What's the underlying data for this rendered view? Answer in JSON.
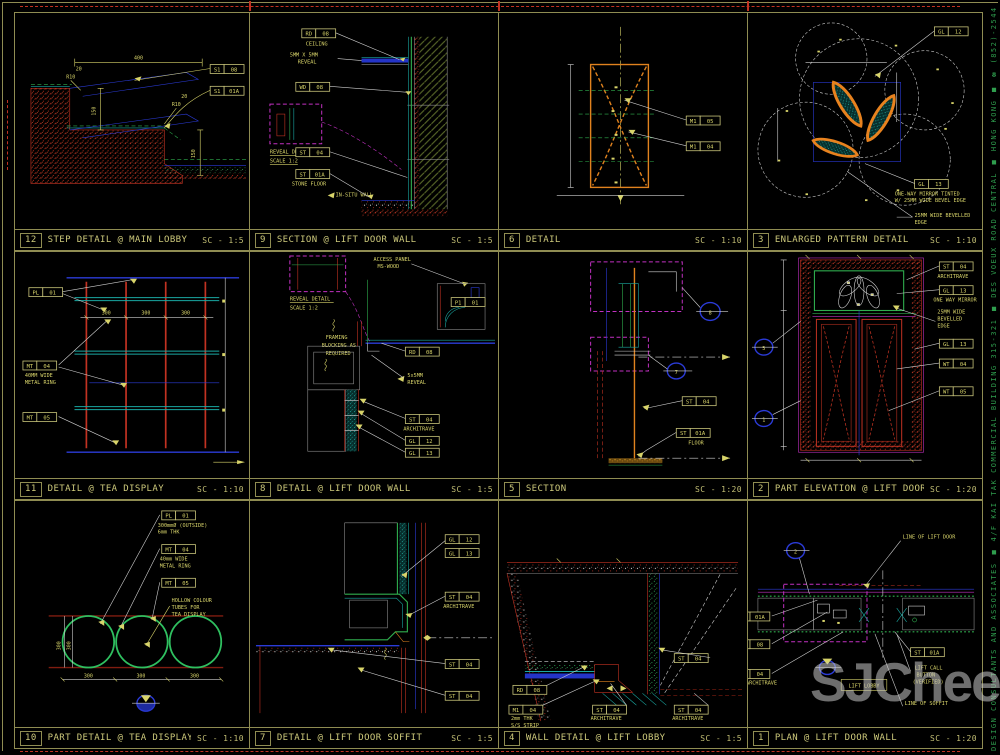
{
  "page": {
    "watermark": "SJCheese",
    "margin_text": "DESIGN CONSULTANTS AND ASSOCIATES ■ 4/F KAI TAK COMMERCIAL BUILDING 315-321 ■ DES VOEUX ROAD CENTRAL ■ HONG KONG ■ ☎ (852)-2544-302"
  },
  "panels": [
    {
      "num": "12",
      "title": "STEP DETAIL @ MAIN LOBBY",
      "scale": "SC - 1:5",
      "tags": [
        [
          "S1",
          "08"
        ],
        [
          "S1",
          "01A"
        ]
      ],
      "dims": [
        "400",
        "150",
        "150",
        "R10",
        "R10",
        "20",
        "20"
      ]
    },
    {
      "num": "9",
      "title": "SECTION @ LIFT DOOR WALL",
      "scale": "SC - 1:5",
      "tags": [
        [
          "RD",
          "08"
        ],
        [
          "WD",
          "08"
        ],
        [
          "ST",
          "04"
        ],
        [
          "ST",
          "01A"
        ]
      ],
      "labels": [
        "CEILING",
        "REVEAL DETAIL",
        "SCALE 1:2",
        "STONE FLOOR",
        "IN-SITU WALL",
        "5MM X 5MM",
        "REVEAL"
      ]
    },
    {
      "num": "6",
      "title": "DETAIL",
      "scale": "SC - 1:10",
      "tags": [
        [
          "M1",
          "05"
        ],
        [
          "M1",
          "04"
        ]
      ]
    },
    {
      "num": "3",
      "title": "ENLARGED PATTERN DETAIL",
      "scale": "SC - 1:10",
      "tags": [
        [
          "GL",
          "12"
        ],
        [
          "GL",
          "13"
        ]
      ],
      "labels": [
        "ONE-WAY MIRROR TINTED",
        "W/ 25MM WIDE BEVEL EDGE",
        "25MM WIDE BEVELLED",
        "EDGE"
      ]
    },
    {
      "num": "11",
      "title": "DETAIL @ TEA DISPLAY",
      "scale": "SC - 1:10",
      "tags": [
        [
          "PL",
          "01"
        ],
        [
          "MT",
          "04"
        ],
        [
          "MT",
          "05"
        ]
      ],
      "labels": [
        "40MM WIDE",
        "METAL RING"
      ],
      "dims": [
        "300",
        "300",
        "300"
      ]
    },
    {
      "num": "8",
      "title": "DETAIL @ LIFT DOOR WALL",
      "scale": "SC - 1:5",
      "tags": [
        [
          "P1",
          "01"
        ],
        [
          "RD",
          "08"
        ],
        [
          "ST",
          "04"
        ],
        [
          "GL",
          "12"
        ],
        [
          "GL",
          "13"
        ]
      ],
      "labels": [
        "ACCESS PANEL",
        "MS-WOOD",
        "REVEAL DETAIL",
        "SCALE 1:2",
        "FRAMING",
        "BLOCKING AS",
        "REQUIRED",
        "5x5MM",
        "REVEAL",
        "ARCHITRAVE"
      ]
    },
    {
      "num": "5",
      "title": "SECTION",
      "scale": "SC - 1:20",
      "tags": [
        [
          "ST",
          "04"
        ],
        [
          "ST",
          "01A"
        ]
      ],
      "labels": [
        "FLOOR"
      ],
      "callouts": [
        "8",
        "7"
      ]
    },
    {
      "num": "2",
      "title": "PART ELEVATION @ LIFT DOOR",
      "scale": "SC - 1:20",
      "tags": [
        [
          "ST",
          "04"
        ],
        [
          "GL",
          "13"
        ],
        [
          "GL",
          "13"
        ],
        [
          "WT",
          "04"
        ],
        [
          "WT",
          "05"
        ]
      ],
      "labels": [
        "ARCHITRAVE",
        "ONE WAY MIRROR",
        "25MM WIDE",
        "BEVELLED",
        "EDGE"
      ],
      "callouts": [
        "5",
        "1"
      ]
    },
    {
      "num": "10",
      "title": "PART DETAIL @ TEA DISPLAY",
      "scale": "SC - 1:10",
      "tags": [
        [
          "PL",
          "01"
        ],
        [
          "MT",
          "04"
        ],
        [
          "MT",
          "05"
        ]
      ],
      "labels": [
        "300mmØ (OUTSIDE)",
        "6mm THK",
        "40mm WIDE",
        "METAL RING",
        "HOLLOW COLOUR",
        "TUBES FOR",
        "TEA DISPLAY"
      ],
      "dims": [
        "300",
        "300",
        "300",
        "300",
        "300"
      ]
    },
    {
      "num": "7",
      "title": "DETAIL @ LIFT DOOR SOFFIT",
      "scale": "SC - 1:5",
      "tags": [
        [
          "GL",
          "12"
        ],
        [
          "GL",
          "13"
        ],
        [
          "ST",
          "04"
        ],
        [
          "ST",
          "04"
        ],
        [
          "ST",
          "04"
        ]
      ],
      "labels": [
        "ARCHITRAVE"
      ]
    },
    {
      "num": "4",
      "title": "WALL DETAIL @ LIFT LOBBY",
      "scale": "SC - 1:5",
      "tags": [
        [
          "RD",
          "08"
        ],
        [
          "M1",
          "04"
        ],
        [
          "ST",
          "04"
        ],
        [
          "ST",
          "04"
        ],
        [
          "ST",
          "04"
        ]
      ],
      "labels": [
        "2mm THK",
        "S/S STRIP",
        "ARCHITRAVE",
        "ARCHITRAVE"
      ]
    },
    {
      "num": "1",
      "title": "PLAN @ LIFT DOOR WALL",
      "scale": "SC - 1:20",
      "tags": [
        [
          "ST",
          "01A"
        ],
        [
          "WD",
          "08"
        ],
        [
          "ST",
          "04"
        ],
        [
          "ST",
          "01A"
        ]
      ],
      "labels": [
        "LINE OF LIFT DOOR",
        "LIFT LOBBY",
        "LIFT CALL",
        "BUTTON",
        "(VERIFIED)",
        "LINE OF SOFFIT",
        "ARCHITRAVE"
      ],
      "callouts": [
        "2"
      ]
    }
  ]
}
